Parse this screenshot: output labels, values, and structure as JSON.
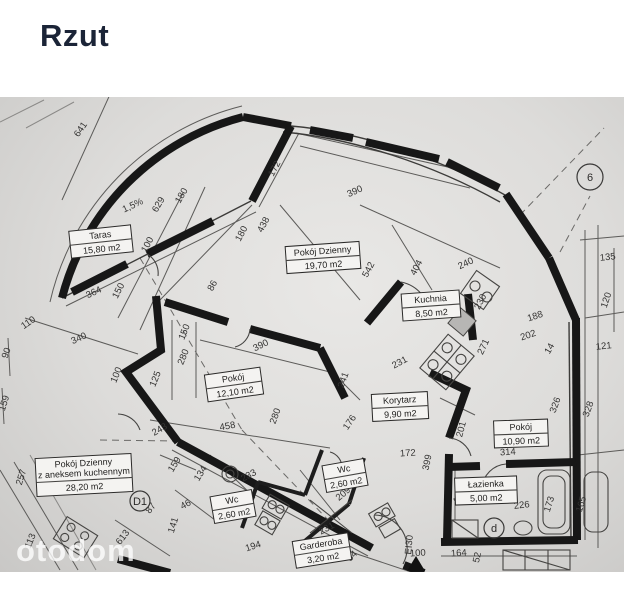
{
  "header": {
    "title": "Rzut"
  },
  "watermark": {
    "text": "otodom"
  },
  "plan": {
    "rooms": [
      {
        "lines": [
          "Taras"
        ],
        "area": "15,80 m2",
        "x": 70,
        "y": 228,
        "w": 62,
        "rot": -6
      },
      {
        "lines": [
          "Pokój Dzienny"
        ],
        "area": "19,70 m2",
        "x": 286,
        "y": 244,
        "w": 74,
        "rot": -4
      },
      {
        "lines": [
          "Kuchnia"
        ],
        "area": "8,50 m2",
        "x": 402,
        "y": 292,
        "w": 58,
        "rot": -4
      },
      {
        "lines": [
          "Pokój"
        ],
        "area": "12,10 m2",
        "x": 206,
        "y": 371,
        "w": 56,
        "rot": -8
      },
      {
        "lines": [
          "Korytarz"
        ],
        "area": "9,90 m2",
        "x": 372,
        "y": 393,
        "w": 56,
        "rot": -3
      },
      {
        "lines": [
          "Pokój"
        ],
        "area": "10,90 m2",
        "x": 494,
        "y": 420,
        "w": 54,
        "rot": -2
      },
      {
        "lines": [
          "Pokój Dzienny",
          "z aneksem kuchennym"
        ],
        "area": "28,20 m2",
        "x": 36,
        "y": 456,
        "w": 96,
        "rot": -3
      },
      {
        "lines": [
          "Wc"
        ],
        "area": "2,60 m2",
        "x": 324,
        "y": 462,
        "w": 42,
        "rot": -10
      },
      {
        "lines": [
          "Wc"
        ],
        "area": "2,60 m2",
        "x": 212,
        "y": 493,
        "w": 42,
        "rot": -10
      },
      {
        "lines": [
          "Łazienka"
        ],
        "area": "5,00 m2",
        "x": 455,
        "y": 477,
        "w": 62,
        "rot": -2
      },
      {
        "lines": [
          "Garderoba"
        ],
        "area": "3,20 m2",
        "x": 294,
        "y": 537,
        "w": 56,
        "rot": -9
      }
    ],
    "dimensions": [
      {
        "t": "641",
        "x": 83,
        "y": 131,
        "r": -55
      },
      {
        "t": "1,5%",
        "x": 134,
        "y": 208,
        "r": -25
      },
      {
        "t": "629",
        "x": 161,
        "y": 206,
        "r": -60
      },
      {
        "t": "180",
        "x": 184,
        "y": 197,
        "r": -60
      },
      {
        "t": "100",
        "x": 150,
        "y": 246,
        "r": -62
      },
      {
        "t": "150",
        "x": 121,
        "y": 292,
        "r": -63
      },
      {
        "t": "364",
        "x": 95,
        "y": 295,
        "r": -25
      },
      {
        "t": "86",
        "x": 215,
        "y": 287,
        "r": -62
      },
      {
        "t": "172",
        "x": 277,
        "y": 170,
        "r": -62
      },
      {
        "t": "390",
        "x": 356,
        "y": 194,
        "r": -24
      },
      {
        "t": "180",
        "x": 244,
        "y": 235,
        "r": -62
      },
      {
        "t": "438",
        "x": 266,
        "y": 226,
        "r": -62
      },
      {
        "t": "542",
        "x": 371,
        "y": 271,
        "r": -62
      },
      {
        "t": "404",
        "x": 419,
        "y": 269,
        "r": -62
      },
      {
        "t": "240",
        "x": 467,
        "y": 266,
        "r": -25
      },
      {
        "t": "230",
        "x": 483,
        "y": 303,
        "r": -63
      },
      {
        "t": "188",
        "x": 536,
        "y": 319,
        "r": -18
      },
      {
        "t": "202",
        "x": 529,
        "y": 338,
        "r": -18
      },
      {
        "t": "14",
        "x": 552,
        "y": 350,
        "r": -60
      },
      {
        "t": "271",
        "x": 486,
        "y": 348,
        "r": -65
      },
      {
        "t": "231",
        "x": 401,
        "y": 365,
        "r": -28
      },
      {
        "t": "150",
        "x": 187,
        "y": 333,
        "r": -68
      },
      {
        "t": "280",
        "x": 186,
        "y": 358,
        "r": -68
      },
      {
        "t": "125",
        "x": 158,
        "y": 380,
        "r": -68
      },
      {
        "t": "390",
        "x": 262,
        "y": 348,
        "r": -26
      },
      {
        "t": "280",
        "x": 278,
        "y": 417,
        "r": -70
      },
      {
        "t": "243",
        "x": 161,
        "y": 432,
        "r": -30
      },
      {
        "t": "458",
        "x": 228,
        "y": 429,
        "r": -10
      },
      {
        "t": "110",
        "x": 30,
        "y": 325,
        "r": -35
      },
      {
        "t": "340",
        "x": 80,
        "y": 341,
        "r": -24
      },
      {
        "t": "90",
        "x": 9,
        "y": 354,
        "r": -70
      },
      {
        "t": "100",
        "x": 119,
        "y": 376,
        "r": -68
      },
      {
        "t": "159",
        "x": 7,
        "y": 404,
        "r": -73
      },
      {
        "t": "241",
        "x": 346,
        "y": 381,
        "r": -70
      },
      {
        "t": "176",
        "x": 352,
        "y": 424,
        "r": -55
      },
      {
        "t": "172",
        "x": 408,
        "y": 456,
        "r": -4
      },
      {
        "t": "399",
        "x": 430,
        "y": 463,
        "r": -78
      },
      {
        "t": "201",
        "x": 464,
        "y": 430,
        "r": -75
      },
      {
        "t": "326",
        "x": 558,
        "y": 406,
        "r": -70
      },
      {
        "t": "328",
        "x": 591,
        "y": 410,
        "r": -70
      },
      {
        "t": "314",
        "x": 508,
        "y": 455,
        "r": -4
      },
      {
        "t": "135",
        "x": 608,
        "y": 260,
        "r": -6
      },
      {
        "t": "120",
        "x": 609,
        "y": 301,
        "r": -72
      },
      {
        "t": "121",
        "x": 604,
        "y": 349,
        "r": -6
      },
      {
        "t": "257",
        "x": 24,
        "y": 478,
        "r": -73
      },
      {
        "t": "159",
        "x": 177,
        "y": 466,
        "r": -58
      },
      {
        "t": "87",
        "x": 153,
        "y": 510,
        "r": -52
      },
      {
        "t": "141",
        "x": 176,
        "y": 526,
        "r": -73
      },
      {
        "t": "613",
        "x": 125,
        "y": 539,
        "r": -52
      },
      {
        "t": "113",
        "x": 33,
        "y": 542,
        "r": -68
      },
      {
        "t": "134",
        "x": 203,
        "y": 475,
        "r": -58
      },
      {
        "t": "46",
        "x": 187,
        "y": 507,
        "r": -28
      },
      {
        "t": "233",
        "x": 250,
        "y": 478,
        "r": -28
      },
      {
        "t": "194",
        "x": 254,
        "y": 549,
        "r": -18
      },
      {
        "t": "209",
        "x": 345,
        "y": 496,
        "r": -40
      },
      {
        "t": "231",
        "x": 328,
        "y": 531,
        "r": -28
      },
      {
        "t": "226",
        "x": 522,
        "y": 508,
        "r": -6
      },
      {
        "t": "173",
        "x": 552,
        "y": 505,
        "r": -73
      },
      {
        "t": "165",
        "x": 584,
        "y": 505,
        "r": -73
      },
      {
        "t": "125",
        "x": 461,
        "y": 495,
        "r": -78
      },
      {
        "t": "164",
        "x": 459,
        "y": 556,
        "r": -4
      },
      {
        "t": "100",
        "x": 418,
        "y": 556,
        "r": -4
      },
      {
        "t": "52",
        "x": 480,
        "y": 558,
        "r": -78
      },
      {
        "t": "EI30",
        "x": 412,
        "y": 545,
        "r": -85
      },
      {
        "t": "84",
        "x": 354,
        "y": 558,
        "r": -45
      }
    ],
    "markers": [
      {
        "t": "6",
        "x": 590,
        "y": 177,
        "rad": 13
      },
      {
        "t": "D1",
        "x": 140,
        "y": 501,
        "rad": 10
      },
      {
        "t": "d",
        "x": 494,
        "y": 528,
        "rad": 10
      }
    ]
  }
}
